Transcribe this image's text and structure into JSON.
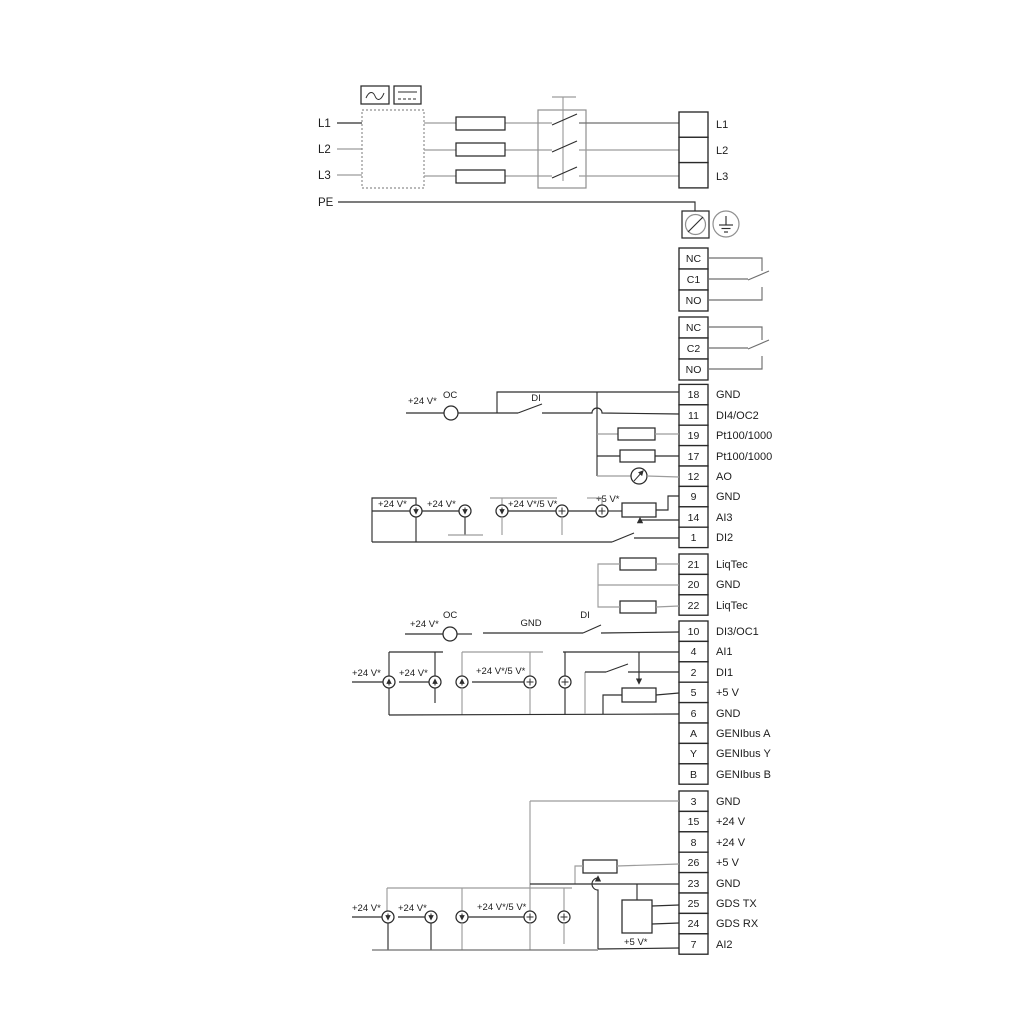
{
  "power": {
    "in": [
      "L1",
      "L2",
      "L3",
      "PE"
    ],
    "out": [
      "L1",
      "L2",
      "L3"
    ]
  },
  "relays": {
    "r1": [
      "NC",
      "C1",
      "NO"
    ],
    "r2": [
      "NC",
      "C2",
      "NO"
    ]
  },
  "t1": [
    {
      "n": "18",
      "l": "GND"
    },
    {
      "n": "11",
      "l": "DI4/OC2"
    },
    {
      "n": "19",
      "l": "Pt100/1000"
    },
    {
      "n": "17",
      "l": "Pt100/1000"
    },
    {
      "n": "12",
      "l": "AO"
    },
    {
      "n": "9",
      "l": "GND"
    },
    {
      "n": "14",
      "l": "AI3"
    },
    {
      "n": "1",
      "l": "DI2"
    }
  ],
  "t2": [
    {
      "n": "21",
      "l": "LiqTec"
    },
    {
      "n": "20",
      "l": "GND"
    },
    {
      "n": "22",
      "l": "LiqTec"
    }
  ],
  "t3": [
    {
      "n": "10",
      "l": "DI3/OC1"
    },
    {
      "n": "4",
      "l": "AI1"
    },
    {
      "n": "2",
      "l": "DI1"
    },
    {
      "n": "5",
      "l": "+5 V"
    },
    {
      "n": "6",
      "l": "GND"
    },
    {
      "n": "A",
      "l": "GENIbus A"
    },
    {
      "n": "Y",
      "l": "GENIbus Y"
    },
    {
      "n": "B",
      "l": "GENIbus B"
    }
  ],
  "t4": [
    {
      "n": "3",
      "l": "GND"
    },
    {
      "n": "15",
      "l": "+24 V"
    },
    {
      "n": "8",
      "l": "+24 V"
    },
    {
      "n": "26",
      "l": "+5 V"
    },
    {
      "n": "23",
      "l": "GND"
    },
    {
      "n": "25",
      "l": "GDS TX"
    },
    {
      "n": "24",
      "l": "GDS RX"
    },
    {
      "n": "7",
      "l": "AI2"
    }
  ],
  "ann": {
    "v24": "+24 V*",
    "v245": "+24 V*/5 V*",
    "v5": "+5 V*",
    "oc": "OC",
    "di": "DI",
    "gnd": "GND"
  },
  "colors": {
    "wire_black": "#2e2e2e",
    "wire_gray": "#9c9c9c",
    "background": "#ffffff"
  }
}
